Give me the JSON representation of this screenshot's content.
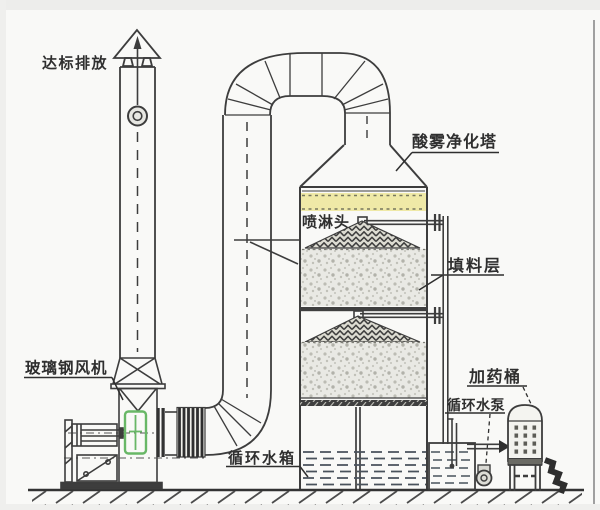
{
  "labels": {
    "emission": "达标排放",
    "fan": "玻璃钢风机",
    "tower": "酸雾净化塔",
    "spray_head": "喷淋头",
    "packing": "填料层",
    "pump": "循环水泵",
    "tank": "循环水箱",
    "barrel": "加药桶"
  },
  "colors": {
    "line": "#3d3d3d",
    "demister_band": "#efe9a7",
    "fan_inlet_highlight": "#68b766",
    "water": "#49525c",
    "background": "#f9f9f7"
  }
}
